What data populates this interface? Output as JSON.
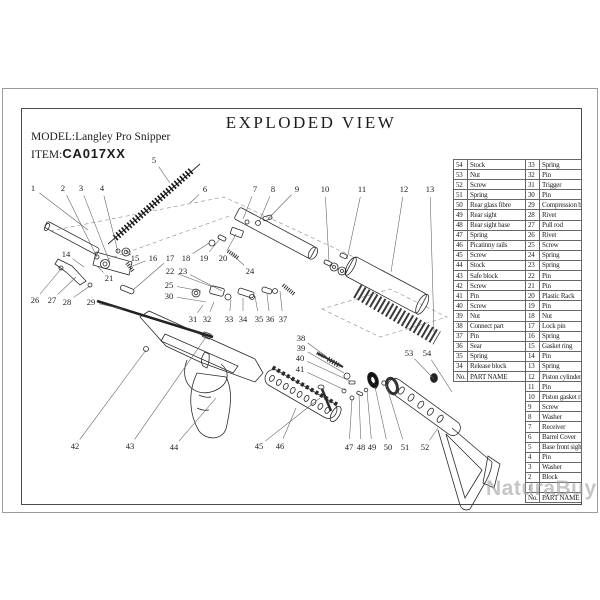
{
  "title": "EXPLODED VIEW",
  "model_label": "MODEL:",
  "model_value": "Langley Pro Snipper",
  "item_label": "ITEM:",
  "item_value": "CA017XX",
  "watermark": "NaturaBuy",
  "line_color": "#2b2b2b",
  "table": {
    "header_no": "No.",
    "header_name": "PART NAME",
    "left_rows": [
      {
        "no": "54",
        "name": "Stock"
      },
      {
        "no": "53",
        "name": "Nut"
      },
      {
        "no": "52",
        "name": "Screw"
      },
      {
        "no": "51",
        "name": "Spring"
      },
      {
        "no": "50",
        "name": "Rear glass fibre"
      },
      {
        "no": "49",
        "name": "Rear sight"
      },
      {
        "no": "48",
        "name": "Rear sight base"
      },
      {
        "no": "47",
        "name": "Spring"
      },
      {
        "no": "46",
        "name": "Picatinny rails"
      },
      {
        "no": "45",
        "name": "Screw"
      },
      {
        "no": "44",
        "name": "Stock"
      },
      {
        "no": "43",
        "name": "Safe block"
      },
      {
        "no": "42",
        "name": "Screw"
      },
      {
        "no": "41",
        "name": "Pin"
      },
      {
        "no": "40",
        "name": "Screw"
      },
      {
        "no": "39",
        "name": "Nut"
      },
      {
        "no": "38",
        "name": "Connect part"
      },
      {
        "no": "37",
        "name": "Pin"
      },
      {
        "no": "36",
        "name": "Sear"
      },
      {
        "no": "35",
        "name": "Spring"
      },
      {
        "no": "34",
        "name": "Release block"
      }
    ],
    "right_rows": [
      {
        "no": "33",
        "name": "Spring"
      },
      {
        "no": "32",
        "name": "Pin"
      },
      {
        "no": "31",
        "name": "Trigger"
      },
      {
        "no": "30",
        "name": "Pin"
      },
      {
        "no": "29",
        "name": "Compression bar"
      },
      {
        "no": "28",
        "name": "Rivet"
      },
      {
        "no": "27",
        "name": "Pull rod"
      },
      {
        "no": "26",
        "name": "Rivet"
      },
      {
        "no": "25",
        "name": "Screw"
      },
      {
        "no": "24",
        "name": "Spring"
      },
      {
        "no": "23",
        "name": "Spring"
      },
      {
        "no": "22",
        "name": "Pin"
      },
      {
        "no": "21",
        "name": "Pin"
      },
      {
        "no": "20",
        "name": "Plastic Rack"
      },
      {
        "no": "19",
        "name": "Pin"
      },
      {
        "no": "18",
        "name": "Nut"
      },
      {
        "no": "17",
        "name": "Lock pin"
      },
      {
        "no": "16",
        "name": "Spring"
      },
      {
        "no": "15",
        "name": "Gasket ring"
      },
      {
        "no": "14",
        "name": "Pin"
      },
      {
        "no": "13",
        "name": "Spring"
      },
      {
        "no": "12",
        "name": "Piston cylinder"
      },
      {
        "no": "11",
        "name": "Pin"
      },
      {
        "no": "10",
        "name": "Piston gasket ring"
      },
      {
        "no": "9",
        "name": "Screw"
      },
      {
        "no": "8",
        "name": "Washer"
      },
      {
        "no": "7",
        "name": "Receiver"
      },
      {
        "no": "6",
        "name": "Barrel Cover"
      },
      {
        "no": "5",
        "name": "Base front sight"
      },
      {
        "no": "4",
        "name": "Pin"
      },
      {
        "no": "3",
        "name": "Washer"
      },
      {
        "no": "2",
        "name": "Block"
      },
      {
        "no": "1",
        "name": ""
      }
    ]
  },
  "callouts": [
    {
      "n": "1",
      "x": 33,
      "y": 188,
      "tx": 88,
      "ty": 230
    },
    {
      "n": "2",
      "x": 63,
      "y": 188,
      "tx": 97,
      "ty": 257
    },
    {
      "n": "3",
      "x": 81,
      "y": 188,
      "tx": 110,
      "ty": 263
    },
    {
      "n": "4",
      "x": 102,
      "y": 188,
      "tx": 118,
      "ty": 252
    },
    {
      "n": "5",
      "x": 154,
      "y": 160,
      "tx": 170,
      "ty": 183
    },
    {
      "n": "6",
      "x": 205,
      "y": 189,
      "tx": 190,
      "ty": 203
    },
    {
      "n": "7",
      "x": 255,
      "y": 189,
      "tx": 243,
      "ty": 219
    },
    {
      "n": "8",
      "x": 273,
      "y": 189,
      "tx": 259,
      "ty": 222
    },
    {
      "n": "9",
      "x": 297,
      "y": 189,
      "tx": 268,
      "ty": 219
    },
    {
      "n": "10",
      "x": 325,
      "y": 189,
      "tx": 329,
      "ty": 262
    },
    {
      "n": "11",
      "x": 362,
      "y": 189,
      "tx": 347,
      "ty": 259
    },
    {
      "n": "12",
      "x": 404,
      "y": 189,
      "tx": 391,
      "ty": 272
    },
    {
      "n": "13",
      "x": 430,
      "y": 189,
      "tx": 434,
      "ty": 332
    },
    {
      "n": "14",
      "x": 66,
      "y": 254,
      "tx": 84,
      "ty": 267
    },
    {
      "n": "15",
      "x": 135,
      "y": 258,
      "tx": 126,
      "ty": 251
    },
    {
      "n": "16",
      "x": 153,
      "y": 258,
      "tx": 130,
      "ty": 267
    },
    {
      "n": "17",
      "x": 170,
      "y": 258,
      "tx": 133,
      "ty": 290
    },
    {
      "n": "18",
      "x": 186,
      "y": 258,
      "tx": 209,
      "ty": 243
    },
    {
      "n": "19",
      "x": 204,
      "y": 258,
      "tx": 220,
      "ty": 239
    },
    {
      "n": "20",
      "x": 223,
      "y": 258,
      "tx": 236,
      "ty": 234
    },
    {
      "n": "21",
      "x": 109,
      "y": 278,
      "tx": 97,
      "ty": 266
    },
    {
      "n": "22",
      "x": 170,
      "y": 271,
      "tx": 213,
      "ty": 287
    },
    {
      "n": "23",
      "x": 183,
      "y": 271,
      "tx": 222,
      "ty": 291
    },
    {
      "n": "24",
      "x": 250,
      "y": 271,
      "tx": 232,
      "ty": 254
    },
    {
      "n": "25",
      "x": 169,
      "y": 285,
      "tx": 201,
      "ty": 291
    },
    {
      "n": "26",
      "x": 35,
      "y": 300,
      "tx": 61,
      "ty": 269
    },
    {
      "n": "27",
      "x": 52,
      "y": 300,
      "tx": 76,
      "ty": 277
    },
    {
      "n": "28",
      "x": 67,
      "y": 302,
      "tx": 90,
      "ty": 286
    },
    {
      "n": "29",
      "x": 91,
      "y": 302,
      "tx": 123,
      "ty": 309
    },
    {
      "n": "30",
      "x": 169,
      "y": 296,
      "tx": 206,
      "ty": 302
    },
    {
      "n": "31",
      "x": 193,
      "y": 319,
      "tx": 203,
      "ty": 305
    },
    {
      "n": "32",
      "x": 207,
      "y": 319,
      "tx": 214,
      "ty": 302
    },
    {
      "n": "33",
      "x": 229,
      "y": 319,
      "tx": 231,
      "ty": 300
    },
    {
      "n": "34",
      "x": 243,
      "y": 319,
      "tx": 243,
      "ty": 298
    },
    {
      "n": "35",
      "x": 259,
      "y": 319,
      "tx": 255,
      "ty": 296
    },
    {
      "n": "36",
      "x": 270,
      "y": 319,
      "tx": 267,
      "ty": 294
    },
    {
      "n": "37",
      "x": 283,
      "y": 319,
      "tx": 280,
      "ty": 291
    },
    {
      "n": "38",
      "x": 301,
      "y": 338,
      "tx": 327,
      "ty": 357
    },
    {
      "n": "39",
      "x": 301,
      "y": 348,
      "tx": 344,
      "ty": 373
    },
    {
      "n": "40",
      "x": 300,
      "y": 358,
      "tx": 350,
      "ty": 381
    },
    {
      "n": "41",
      "x": 300,
      "y": 369,
      "tx": 345,
      "ty": 390
    },
    {
      "n": "42",
      "x": 75,
      "y": 446,
      "tx": 146,
      "ty": 350
    },
    {
      "n": "43",
      "x": 130,
      "y": 446,
      "tx": 206,
      "ty": 337
    },
    {
      "n": "44",
      "x": 174,
      "y": 447,
      "tx": 216,
      "ty": 398
    },
    {
      "n": "45",
      "x": 259,
      "y": 446,
      "tx": 320,
      "ty": 398
    },
    {
      "n": "46",
      "x": 280,
      "y": 446,
      "tx": 296,
      "ty": 408
    },
    {
      "n": "47",
      "x": 349,
      "y": 447,
      "tx": 352,
      "ty": 399
    },
    {
      "n": "48",
      "x": 361,
      "y": 447,
      "tx": 359,
      "ty": 395
    },
    {
      "n": "49",
      "x": 372,
      "y": 447,
      "tx": 367,
      "ty": 391
    },
    {
      "n": "50",
      "x": 388,
      "y": 447,
      "tx": 375,
      "ty": 387
    },
    {
      "n": "51",
      "x": 405,
      "y": 447,
      "tx": 386,
      "ty": 384
    },
    {
      "n": "52",
      "x": 425,
      "y": 447,
      "tx": 438,
      "ty": 428
    },
    {
      "n": "53",
      "x": 409,
      "y": 353,
      "tx": 434,
      "ty": 379
    },
    {
      "n": "54",
      "x": 427,
      "y": 353,
      "tx": 452,
      "ty": 392
    }
  ]
}
